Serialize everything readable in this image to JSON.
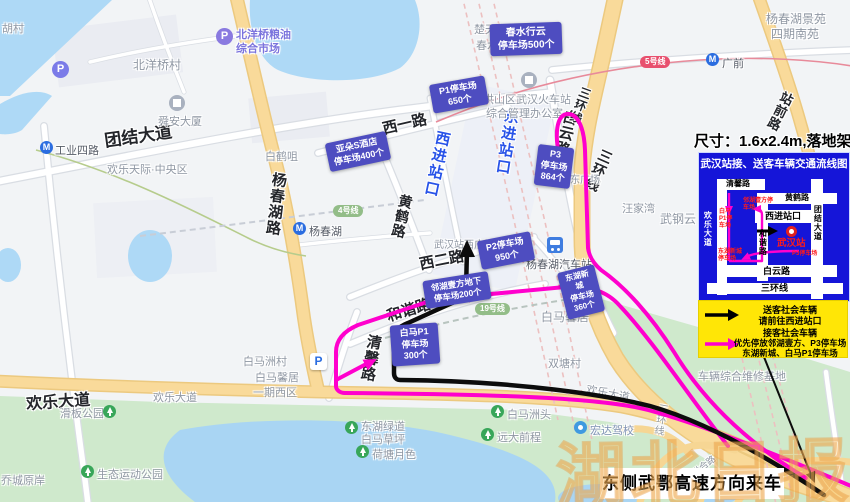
{
  "overlay": {
    "size_note": "尺寸：1.6x2.4m,落地架",
    "incoming_label": "东侧武鄂高速方向来车",
    "watermark": "湖北日报"
  },
  "legend": {
    "title": "武汉站接、送客车辆交通流线图",
    "mini": {
      "qingxinlu": "清馨路",
      "huanghelu": "黄鹤路",
      "xijinzhankou": "西进站口",
      "hexielu": "和谐路",
      "huanledadao": "欢乐大道",
      "tuanjiedadao": "团结大道",
      "baiyunlu": "白云路",
      "sanhuanxian": "三环线",
      "station": "武汉站",
      "p3": "P3停车场",
      "baima_p1": "白马P1停车场",
      "linhu": "邻湖壹方停车场",
      "donghu": "东湖新城停车场"
    },
    "entries": {
      "drop1": "送客社会车辆",
      "drop2": "请前往西进站口",
      "pick1": "接客社会车辆",
      "pick2": "优先停放邻湖壹方、P3停车场",
      "pick3": "东湖新城、白马P1停车场"
    }
  },
  "gates": {
    "west": "西进站口",
    "east": "东进站口"
  },
  "parking": {
    "chunshui": [
      "春水行云",
      "停车场500个"
    ],
    "p1": [
      "P1停车场",
      "650个"
    ],
    "yaduo": [
      "亚朵S酒店",
      "停车场400个"
    ],
    "p3": [
      "P3",
      "停车场",
      "864个"
    ],
    "p2": [
      "P2停车场",
      "950个"
    ],
    "linhu": [
      "邻湖壹方地下",
      "停车场200个"
    ],
    "donghu": [
      "东湖新城",
      "停车场",
      "360个"
    ],
    "baima": [
      "白马P1",
      "停车场",
      "300个"
    ]
  },
  "roads": {
    "tuanjiedadao": "团结大道",
    "gongyesilu": "工业四路",
    "huanledadao": "欢乐大道",
    "huanledadao_grey": "欢乐大道",
    "yangchunhulu": "杨春湖路",
    "xiyilu": "西一路",
    "huanghelu": "黄鹤路",
    "xierlu": "西二路",
    "hexielu": "和谐路",
    "qingxinlu": "清馨路",
    "baiyunlu": "白云路",
    "sanhuanxian": "三环线",
    "zhanqianlu": "站前路",
    "lianhelu": "联合路"
  },
  "pois": {
    "hucun": "胡村",
    "beiyangqiaocun": "北洋桥村",
    "shunandasha": "舜安大厦",
    "baihezui": "白鹤咀",
    "huanletianji": "欢乐天际·中央区",
    "grain_market1": "北洋桥粮油",
    "grain_market2": "综合市场",
    "chutiandushi": "楚天都市",
    "chunshui": "春水",
    "hongshan1": "洪山区武汉火车站",
    "hongshan2": "综合管理办公室",
    "west_square": "武汉站西广场",
    "east_square": "武汉站东广场",
    "wangjiawan": "汪家湾",
    "wugangyun": "武钢云",
    "yangchunhu_station": "杨春湖",
    "baimaxinju": "白马馨居",
    "shuangtangcun": "双塘村",
    "baimazhoucun": "白马洲村",
    "baimaxinju2": "白马馨居",
    "yiqixiqu": "一期西区",
    "huabangongyuan": "滑板公园",
    "shengtaigongyuan": "生态运动公园",
    "qiaochengyuanan": "乔城原岸",
    "donghulvdao": "东湖绿道",
    "baimacaoping": "白马草坪",
    "hetangyuese": "荷塘月色",
    "baimazhoutou": "白马洲头",
    "yuandaqiancheng": "远大前程",
    "hongdajiaxiao": "宏达驾校",
    "bus_station": "杨春湖汽车站",
    "jingyuan1": "杨春湖景苑",
    "jingyuan2": "四期南苑",
    "guangqian": "广前",
    "weixiujidi": "车辆综合维修基地"
  },
  "transit": {
    "line4": "4号线",
    "line5": "5号线",
    "line19": "19号线"
  }
}
